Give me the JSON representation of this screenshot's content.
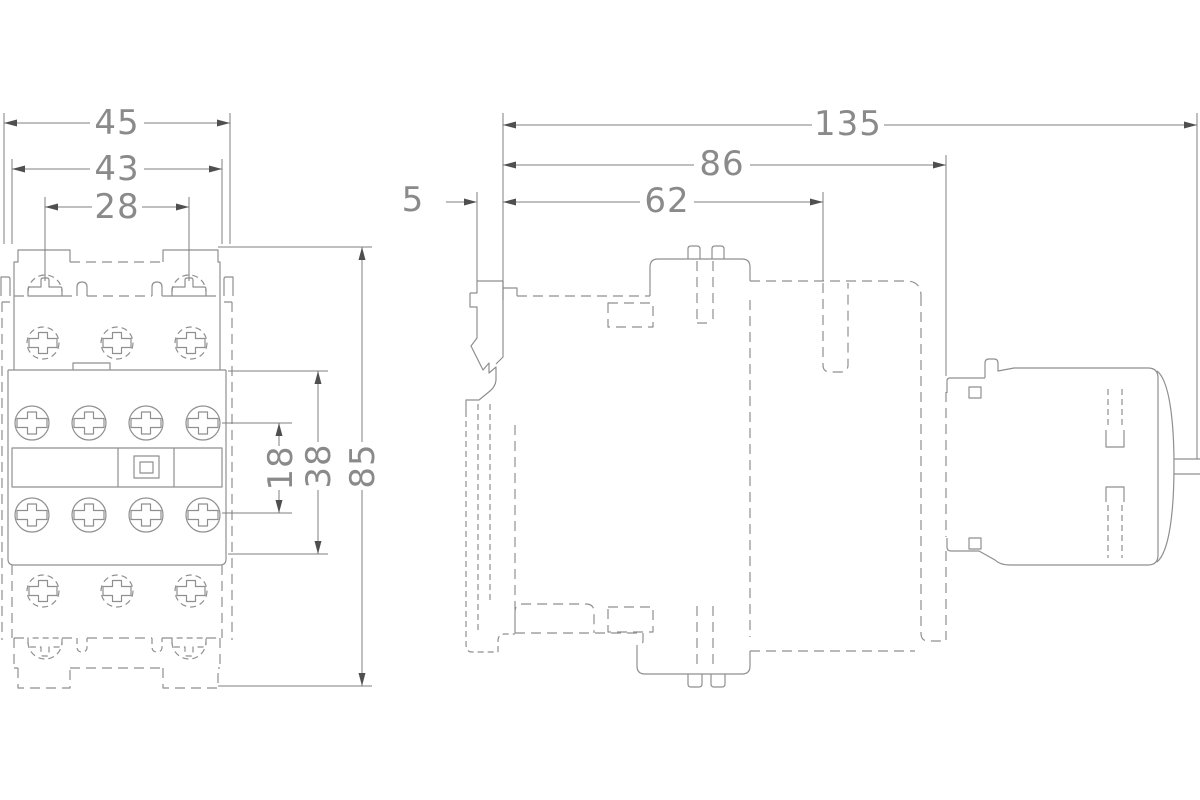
{
  "front_view": {
    "dims": {
      "total_width": "45",
      "body_width": "43",
      "coil_terminal_spacing": "28",
      "aux_terminal_spacing": "18",
      "center_section_height": "38",
      "total_height": "85"
    }
  },
  "side_view": {
    "dims": {
      "total_depth": "135",
      "body_depth": "86",
      "front_depth": "62",
      "rail_offset": "5"
    }
  }
}
